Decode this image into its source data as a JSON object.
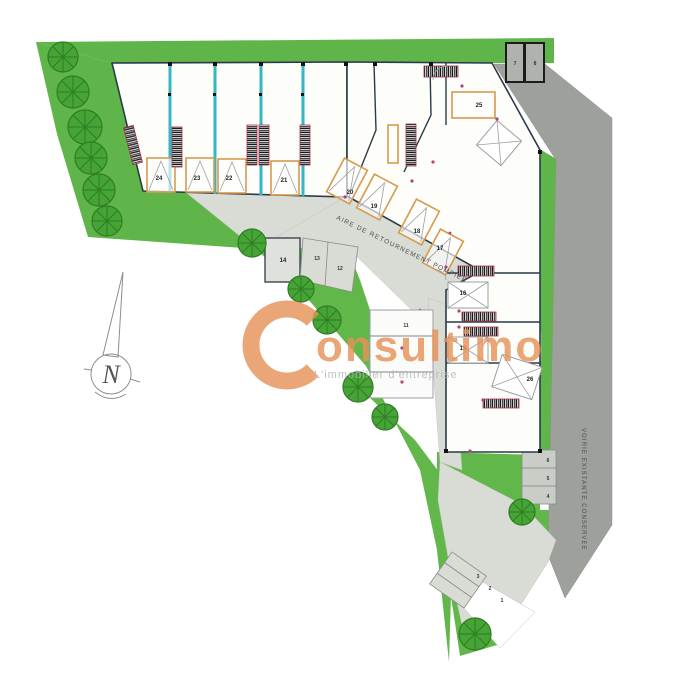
{
  "watermark": {
    "initial": "C",
    "name": "onsultimo",
    "tagline": "L'immobilier d'entreprise",
    "color": "#e6935a"
  },
  "north": {
    "label": "N"
  },
  "roads": {
    "pompier_label": "AIRE DE RETOURNEMENT POMPIER",
    "voirie_label": "VOIRIE EXISTANTE CONSERVEE"
  },
  "units": {
    "top_row": [
      "24",
      "23",
      "22",
      "21"
    ],
    "diagonal_row": [
      "20",
      "19",
      "18",
      "17"
    ],
    "right_column": [
      "16",
      "15"
    ],
    "large_units": [
      "25",
      "26"
    ],
    "center": [
      "14",
      "13",
      "12",
      "11"
    ],
    "top_right_pair": [
      "7",
      "8"
    ],
    "parking_right": [
      "6",
      "5",
      "4"
    ],
    "parking_bottom": [
      "3",
      "2",
      "1"
    ]
  },
  "colors": {
    "green": "#5fb54a",
    "tree": "#46a436",
    "road_light": "#d9dbd5",
    "road_dark": "#9da09b",
    "wall": "#2b3b47",
    "divider_teal": "#35b6c6",
    "door_orange": "#d79a4e",
    "watermark_orange": "#e6935a"
  }
}
